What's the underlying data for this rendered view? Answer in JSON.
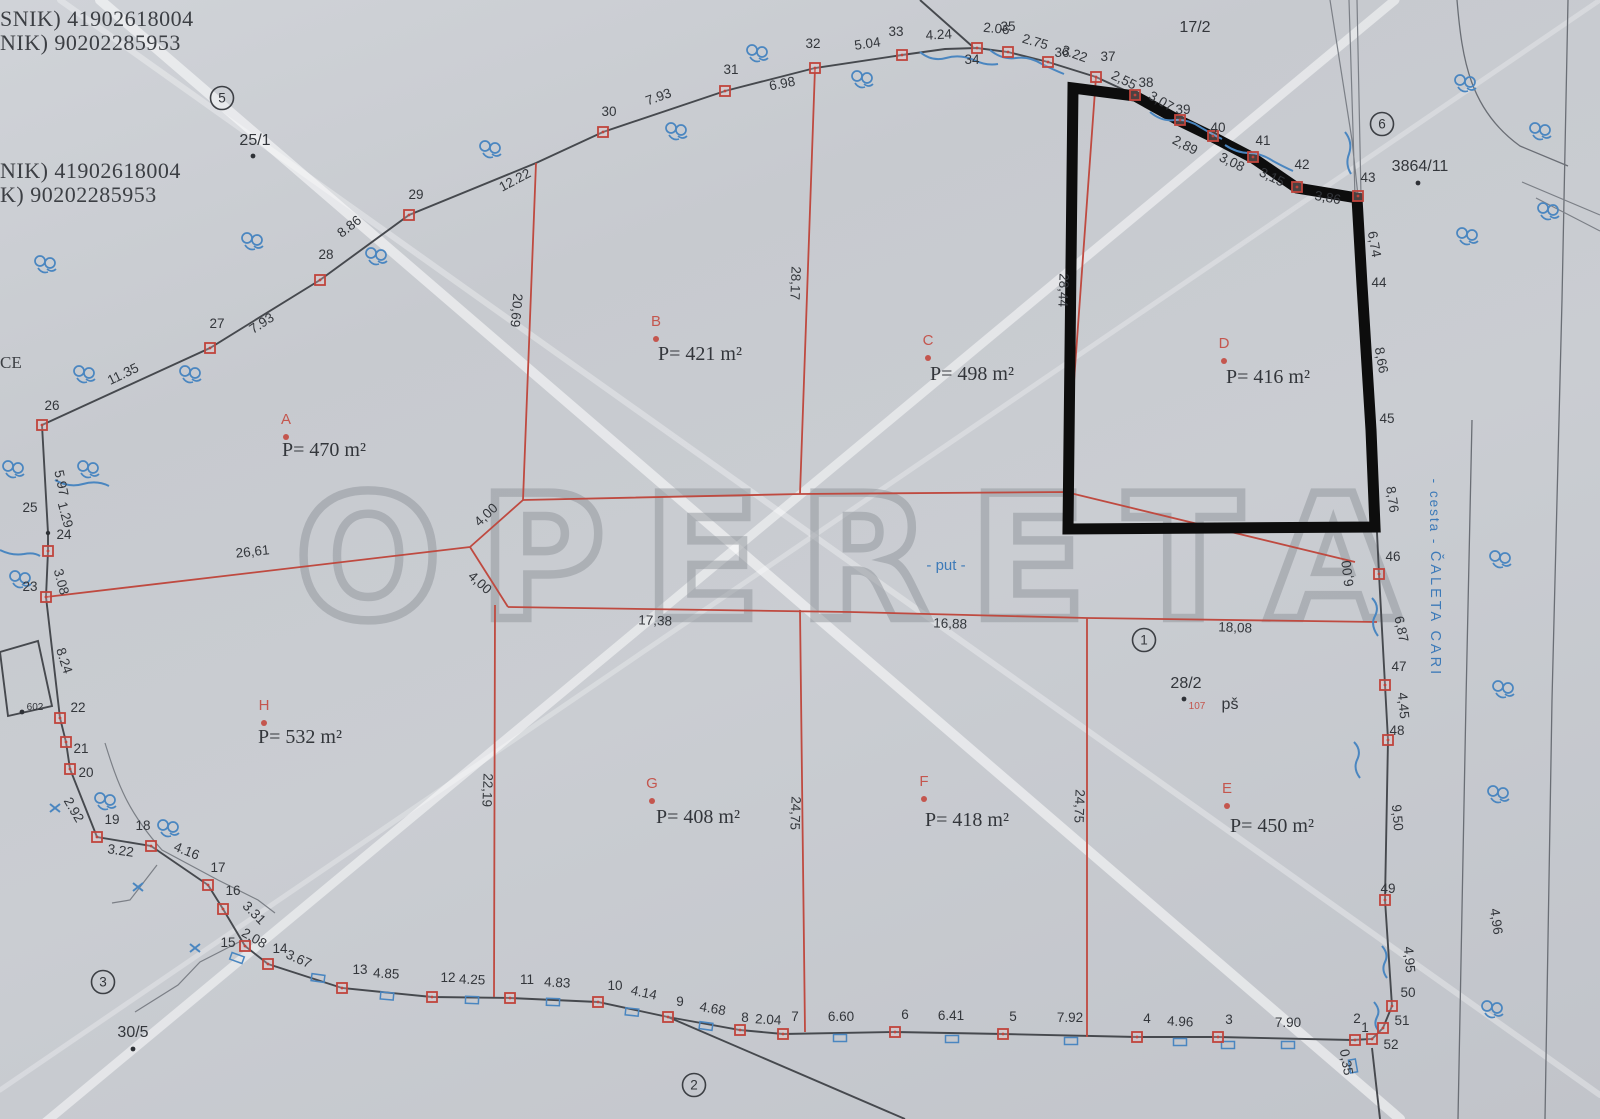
{
  "watermark": {
    "text": "OPERETA"
  },
  "edge_text": "CE",
  "labels": {
    "put": "- put -",
    "cesta": "- cesta -",
    "street": "ČALETA CARI",
    "ps": "pš",
    "house_107": "107"
  },
  "owner_lines": [
    {
      "t": "SNIK) 41902618004",
      "x": 0,
      "y": 26
    },
    {
      "t": "NIK) 90202285953",
      "x": 0,
      "y": 50
    },
    {
      "t": "NIK) 41902618004",
      "x": 0,
      "y": 178
    },
    {
      "t": "K) 90202285953",
      "x": 0,
      "y": 202
    }
  ],
  "parcels": [
    {
      "id": "A",
      "area": "P= 470 m²",
      "lx": 286,
      "ly": 424,
      "tx": 324,
      "ty": 456
    },
    {
      "id": "B",
      "area": "P= 421 m²",
      "lx": 656,
      "ly": 326,
      "tx": 700,
      "ty": 360
    },
    {
      "id": "C",
      "area": "P= 498 m²",
      "lx": 928,
      "ly": 345,
      "tx": 972,
      "ty": 380
    },
    {
      "id": "D",
      "area": "P= 416 m²",
      "lx": 1224,
      "ly": 348,
      "tx": 1268,
      "ty": 383
    },
    {
      "id": "H",
      "area": "P= 532 m²",
      "lx": 264,
      "ly": 710,
      "tx": 300,
      "ty": 743
    },
    {
      "id": "G",
      "area": "P= 408 m²",
      "lx": 652,
      "ly": 788,
      "tx": 698,
      "ty": 823
    },
    {
      "id": "F",
      "area": "P= 418 m²",
      "lx": 924,
      "ly": 786,
      "tx": 967,
      "ty": 826
    },
    {
      "id": "E",
      "area": "P= 450 m²",
      "lx": 1227,
      "ly": 793,
      "tx": 1272,
      "ty": 832
    }
  ],
  "lot_numbers": [
    {
      "t": "25/1",
      "x": 255,
      "y": 145,
      "dot": [
        253,
        156
      ]
    },
    {
      "t": "17/2",
      "x": 1195,
      "y": 32
    },
    {
      "t": "3864/11",
      "x": 1420,
      "y": 171,
      "dot": [
        1418,
        183
      ]
    },
    {
      "t": "28/2",
      "x": 1186,
      "y": 688,
      "dot": [
        1184,
        699
      ]
    },
    {
      "t": "30/5",
      "x": 133,
      "y": 1037,
      "dot": [
        133,
        1049
      ]
    },
    {
      "t": "602",
      "x": 35,
      "y": 710,
      "dot": [
        22,
        712
      ],
      "cls": "tiny"
    }
  ],
  "circled_numbers": [
    {
      "n": "5",
      "x": 222,
      "y": 98
    },
    {
      "n": "6",
      "x": 1382,
      "y": 124
    },
    {
      "n": "1",
      "x": 1144,
      "y": 640
    },
    {
      "n": "2",
      "x": 694,
      "y": 1085
    },
    {
      "n": "3",
      "x": 103,
      "y": 982
    }
  ],
  "point_labels": [
    [
      "26",
      52,
      410
    ],
    [
      "27",
      217,
      328
    ],
    [
      "28",
      326,
      259
    ],
    [
      "29",
      416,
      199
    ],
    [
      "30",
      609,
      116
    ],
    [
      "31",
      731,
      74
    ],
    [
      "32",
      813,
      48
    ],
    [
      "33",
      896,
      36
    ],
    [
      "34",
      972,
      64
    ],
    [
      "35",
      1008,
      31
    ],
    [
      "36",
      1062,
      57
    ],
    [
      "37",
      1108,
      61
    ],
    [
      "38",
      1146,
      87
    ],
    [
      "39",
      1183,
      114
    ],
    [
      "40",
      1218,
      132
    ],
    [
      "41",
      1263,
      145
    ],
    [
      "42",
      1302,
      169
    ],
    [
      "43",
      1368,
      182
    ],
    [
      "44",
      1379,
      287
    ],
    [
      "45",
      1387,
      423
    ],
    [
      "46",
      1393,
      561
    ],
    [
      "47",
      1399,
      671
    ],
    [
      "48",
      1397,
      735
    ],
    [
      "49",
      1388,
      893
    ],
    [
      "50",
      1408,
      997
    ],
    [
      "51",
      1402,
      1025
    ],
    [
      "52",
      1391,
      1049
    ],
    [
      "1",
      1365,
      1032
    ],
    [
      "2",
      1357,
      1023
    ],
    [
      "3",
      1229,
      1024
    ],
    [
      "4",
      1147,
      1023
    ],
    [
      "5",
      1013,
      1021
    ],
    [
      "6",
      905,
      1019
    ],
    [
      "7",
      795,
      1021
    ],
    [
      "8",
      745,
      1022
    ],
    [
      "9",
      680,
      1006
    ],
    [
      "10",
      615,
      990
    ],
    [
      "11",
      527,
      984
    ],
    [
      "12",
      448,
      982
    ],
    [
      "13",
      360,
      974
    ],
    [
      "14",
      280,
      953
    ],
    [
      "15",
      228,
      947
    ],
    [
      "16",
      233,
      895
    ],
    [
      "17",
      218,
      872
    ],
    [
      "18",
      143,
      830
    ],
    [
      "19",
      112,
      824
    ],
    [
      "20",
      86,
      777
    ],
    [
      "21",
      81,
      753
    ],
    [
      "22",
      78,
      712
    ],
    [
      "23",
      30,
      591
    ],
    [
      "24",
      64,
      539
    ],
    [
      "25",
      30,
      512
    ]
  ],
  "measurements": [
    [
      "11.35",
      125,
      378,
      -26
    ],
    [
      "7.93",
      264,
      327,
      -33
    ],
    [
      "8.86",
      352,
      230,
      -38
    ],
    [
      "12.22",
      517,
      184,
      -28
    ],
    [
      "7.93",
      660,
      101,
      -20
    ],
    [
      "6.98",
      783,
      88,
      -11
    ],
    [
      "5.04",
      868,
      48,
      -8
    ],
    [
      "4.24",
      939,
      39,
      -3
    ],
    [
      "2.06",
      996,
      33,
      6
    ],
    [
      "2.75",
      1034,
      46,
      16
    ],
    [
      "3.22",
      1073,
      58,
      20
    ],
    [
      "2,55",
      1122,
      84,
      26
    ],
    [
      "3,07",
      1159,
      105,
      30
    ],
    [
      "2,89",
      1183,
      149,
      28
    ],
    [
      "3,08",
      1230,
      166,
      26
    ],
    [
      "3,15",
      1270,
      181,
      26
    ],
    [
      "3,86",
      1327,
      202,
      10
    ],
    [
      "6,74",
      1370,
      245,
      80
    ],
    [
      "8,66",
      1377,
      361,
      80
    ],
    [
      "8,76",
      1388,
      500,
      82
    ],
    [
      "6,00",
      1352,
      573,
      -97
    ],
    [
      "6,87",
      1397,
      630,
      78
    ],
    [
      "4,45",
      1399,
      706,
      85
    ],
    [
      "9,50",
      1393,
      818,
      85
    ],
    [
      "4,95",
      1405,
      960,
      85
    ],
    [
      "0,35",
      1342,
      1063,
      80
    ],
    [
      "4,96",
      1492,
      922,
      82
    ],
    [
      "5.97",
      57,
      484,
      78
    ],
    [
      "1.29",
      61,
      516,
      75
    ],
    [
      "3.08",
      57,
      583,
      75
    ],
    [
      "8.24",
      60,
      662,
      72
    ],
    [
      "2.92",
      70,
      812,
      60
    ],
    [
      "3.22",
      120,
      855,
      8
    ],
    [
      "4.16",
      185,
      855,
      22
    ],
    [
      "3.31",
      251,
      916,
      45
    ],
    [
      "2.08",
      252,
      942,
      30
    ],
    [
      "3.67",
      297,
      963,
      24
    ],
    [
      "4.85",
      386,
      978,
      3
    ],
    [
      "4.25",
      472,
      984,
      2
    ],
    [
      "4.83",
      557,
      987,
      3
    ],
    [
      "4.14",
      643,
      997,
      12
    ],
    [
      "4.68",
      712,
      1013,
      10
    ],
    [
      "2.04",
      768,
      1024,
      3
    ],
    [
      "6.60",
      841,
      1021,
      0
    ],
    [
      "6.41",
      951,
      1020,
      0
    ],
    [
      "7.92",
      1070,
      1022,
      0
    ],
    [
      "4.96",
      1180,
      1026,
      3
    ],
    [
      "7.90",
      1288,
      1027,
      0
    ],
    [
      "26,61",
      253,
      556,
      -6
    ],
    [
      "4,00",
      489,
      518,
      -43
    ],
    [
      "4,00",
      477,
      586,
      42
    ],
    [
      "20,69",
      512,
      310,
      95
    ],
    [
      "28,17",
      791,
      283,
      92
    ],
    [
      "28,44",
      1059,
      290,
      92
    ],
    [
      "22,19",
      483,
      790,
      92
    ],
    [
      "24,75",
      791,
      813,
      92
    ],
    [
      "24,75",
      1075,
      806,
      92
    ],
    [
      "17,38",
      655,
      625,
      2
    ],
    [
      "16,88",
      950,
      628,
      2
    ],
    [
      "18,08",
      1235,
      632,
      2
    ]
  ],
  "red_squares": [
    [
      42,
      425
    ],
    [
      210,
      348
    ],
    [
      320,
      280
    ],
    [
      409,
      215
    ],
    [
      603,
      132
    ],
    [
      725,
      91
    ],
    [
      815,
      68
    ],
    [
      902,
      55
    ],
    [
      977,
      48
    ],
    [
      1008,
      52
    ],
    [
      1048,
      62
    ],
    [
      1096,
      77
    ],
    [
      1135,
      95
    ],
    [
      1180,
      120
    ],
    [
      1213,
      136
    ],
    [
      1253,
      157
    ],
    [
      1297,
      187
    ],
    [
      1358,
      196
    ],
    [
      1379,
      574
    ],
    [
      1385,
      685
    ],
    [
      1388,
      740
    ],
    [
      1385,
      900
    ],
    [
      1392,
      1006
    ],
    [
      1383,
      1028
    ],
    [
      1372,
      1039
    ],
    [
      1355,
      1040
    ],
    [
      1218,
      1037
    ],
    [
      1137,
      1037
    ],
    [
      1003,
      1034
    ],
    [
      895,
      1032
    ],
    [
      783,
      1034
    ],
    [
      740,
      1030
    ],
    [
      668,
      1017
    ],
    [
      598,
      1002
    ],
    [
      510,
      998
    ],
    [
      432,
      997
    ],
    [
      342,
      988
    ],
    [
      268,
      964
    ],
    [
      245,
      946
    ],
    [
      223,
      909
    ],
    [
      208,
      885
    ],
    [
      151,
      846
    ],
    [
      97,
      837
    ],
    [
      70,
      769
    ],
    [
      66,
      742
    ],
    [
      60,
      718
    ],
    [
      46,
      597
    ],
    [
      48,
      551
    ]
  ],
  "black_dots": [
    [
      48,
      533
    ]
  ],
  "veg": [
    [
      490,
      148
    ],
    [
      676,
      130
    ],
    [
      757,
      52
    ],
    [
      862,
      78
    ],
    [
      376,
      255
    ],
    [
      252,
      240
    ],
    [
      45,
      263
    ],
    [
      84,
      373
    ],
    [
      190,
      373
    ],
    [
      13,
      468
    ],
    [
      88,
      468
    ],
    [
      20,
      578
    ],
    [
      105,
      800
    ],
    [
      168,
      827
    ],
    [
      1465,
      82
    ],
    [
      1467,
      235
    ],
    [
      1540,
      130
    ],
    [
      1548,
      210
    ],
    [
      1500,
      558
    ],
    [
      1503,
      688
    ],
    [
      1498,
      793
    ],
    [
      1492,
      1008
    ]
  ],
  "fences": [
    [
      237,
      958,
      20
    ],
    [
      318,
      978,
      8
    ],
    [
      387,
      996,
      5
    ],
    [
      472,
      1000,
      2
    ],
    [
      553,
      1002,
      2
    ],
    [
      632,
      1012,
      6
    ],
    [
      706,
      1026,
      8
    ],
    [
      840,
      1038,
      0
    ],
    [
      952,
      1039,
      0
    ],
    [
      1071,
      1041,
      0
    ],
    [
      1180,
      1042,
      0
    ],
    [
      1228,
      1045,
      0
    ],
    [
      1288,
      1045,
      0
    ],
    [
      1353,
      1066,
      80
    ]
  ],
  "x_marks": [
    [
      55,
      808
    ],
    [
      138,
      887
    ],
    [
      195,
      948
    ]
  ],
  "colors": {
    "paper": "#c9ccd1",
    "boundary": "#46494e",
    "parcel_line": "#bf4a40",
    "highlight_outline": "#0d0d0d",
    "annotation_blue": "#4a86c0",
    "watermark_gray": "#90959b"
  }
}
